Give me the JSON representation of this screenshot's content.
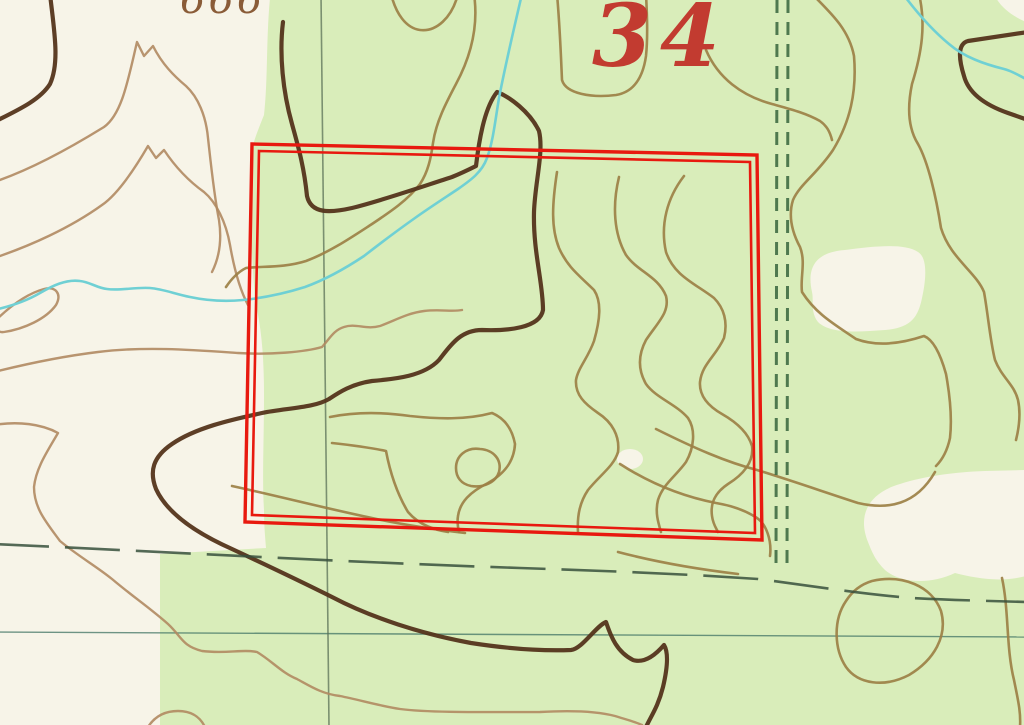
{
  "map": {
    "title": "USGS topographic map excerpt",
    "labels": {
      "section_number": "34",
      "elevation_partial": "666"
    },
    "colors": {
      "paper_white": "#f7f4e8",
      "vegetation_green": "#d9edba",
      "contour_olive": "#9c8045",
      "contour_light_brown": "#b08a62",
      "index_contour_dark_brown": "#54341b",
      "stream_cyan": "#6fd0d4",
      "section_line_green": "#5a7057",
      "trail_dash_green": "#3f6b44",
      "boundary_dash_dark": "#37503c",
      "grid_teal": "#4a7a6a",
      "selection_red": "#e8190f",
      "section_number_red": "#c23b30",
      "elevation_text_brown": "#8a5c38"
    },
    "features": {
      "selection_rectangle": "red double-line parcel highlight, slightly tilted",
      "trail": "vertical double-dashed unimproved road near right side",
      "section_line": "thin vertical green section boundary line",
      "boundary_dash_line": "long-dash boundary line across lower map",
      "grid_line": "thin horizontal teal line across lower map",
      "streams": "cyan intermittent stream lines",
      "contours": "brown elevation contour lines with dark index contours",
      "vegetation": "pale green woodland tint over white clearings"
    }
  }
}
